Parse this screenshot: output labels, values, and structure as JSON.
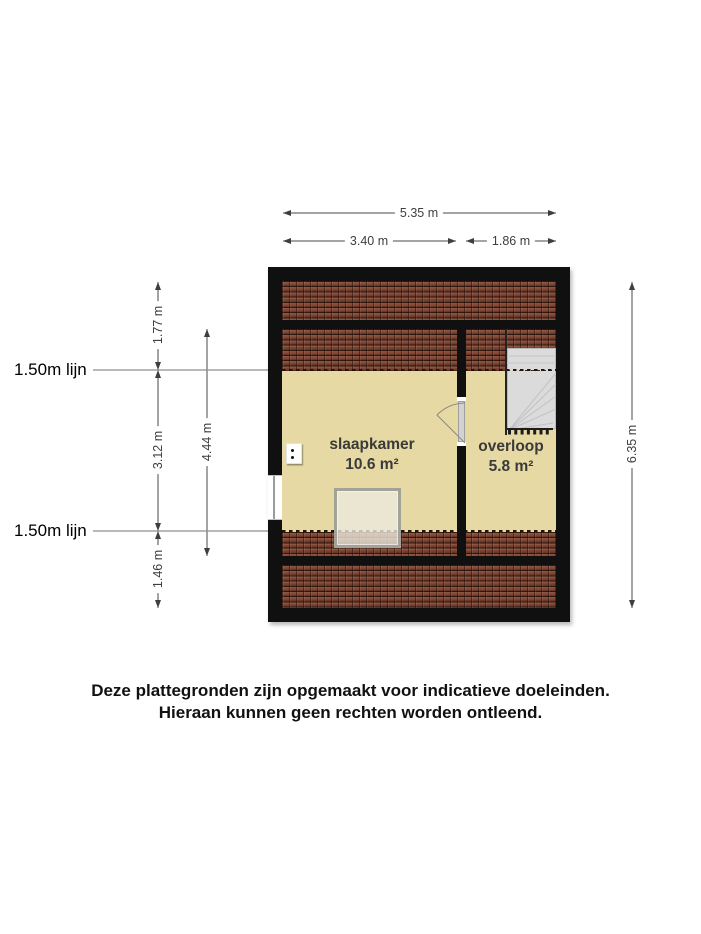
{
  "plan": {
    "rooms": [
      {
        "name": "slaapkamer",
        "area": "10.6 m²"
      },
      {
        "name": "overloop",
        "area": "5.8 m²"
      }
    ],
    "dimensions": {
      "overall_width": "5.35 m",
      "slaapkamer_width": "3.40 m",
      "overloop_width": "1.86 m",
      "overall_depth": "6.35 m",
      "depth_top": "1.77 m",
      "depth_middle": "3.12 m",
      "depth_bottom": "1.46 m",
      "inner_depth": "4.44 m"
    },
    "height_lines": {
      "top_label": "1.50m lijn",
      "bottom_label": "1.50m lijn"
    },
    "fixtures": [
      "stairs",
      "door",
      "window",
      "roof-window",
      "power-socket"
    ]
  },
  "disclaimer": {
    "line1": "Deze plattegronden zijn opgemaakt voor indicatieve doeleinden.",
    "line2": "Hieraan kunnen geen rechten worden ontleend."
  },
  "colors": {
    "wall": "#101010",
    "floor": "#e6d9a3",
    "roof_tile": "#7c4434",
    "stairs": "#dbdbdb",
    "dimension_text": "#3e3e3e"
  }
}
